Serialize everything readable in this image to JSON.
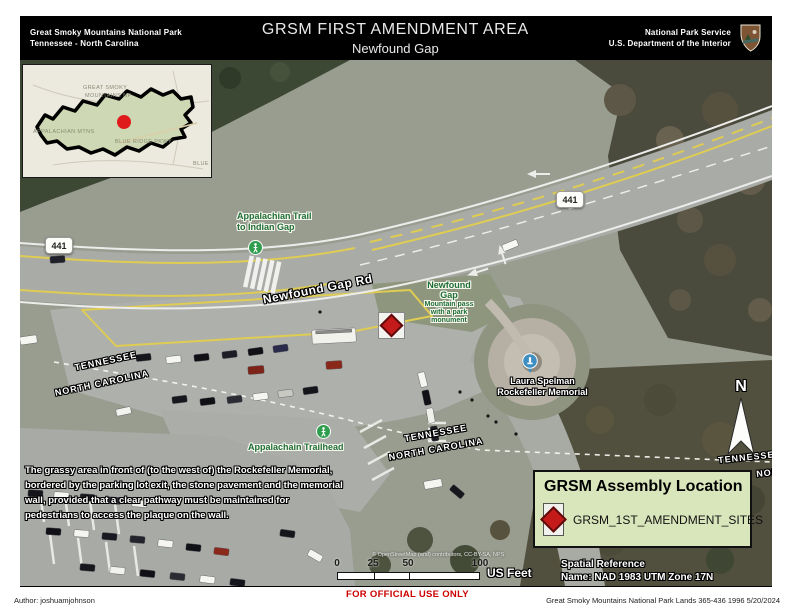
{
  "header": {
    "park_name": "Great Smoky Mountains National Park",
    "park_states": "Tennessee - North Carolina",
    "title": "GRSM FIRST AMENDMENT AREA",
    "subtitle": "Newfound Gap",
    "agency": "National Park Service",
    "department": "U.S. Department of the Interior",
    "logo_icon": "nps-arrowhead-icon"
  },
  "inset": {
    "park_label_line1": "GREAT SMOKY",
    "park_label_line2": "MOUNTAINS NP",
    "region_label": "APPALACHIAN MTNS",
    "parkway_label": "BLUE RIDGE PKWY",
    "edge_label": "BLUE",
    "marker_icon": "red-dot-location-marker"
  },
  "map": {
    "route_shield": "441",
    "trail_label_line1": "Appalachian Trail",
    "trail_label_line2": "to Indian Gap",
    "road_label": "Newfound Gap Rd",
    "gap_label_line1": "Newfound",
    "gap_label_line2": "Gap",
    "gap_sublabel_line1": "Mountain pass",
    "gap_sublabel_line2": "with a park",
    "gap_sublabel_line3": "monument",
    "memorial_label_line1": "Laura Spelman",
    "memorial_label_line2": "Rockefeller Memorial",
    "trailhead_label": "Appalachain Trailhead",
    "state_tennessee": "TENNESSEE",
    "state_north_carolina": "NORTH CAROLINA",
    "north_label": "N",
    "description_lines": [
      "The grassy area in front of (to the west of) the Rockefeller Memorial,",
      "bordered by the parking lot exit, the stone pavement and the memorial",
      "wall, provided that a clear pathway must be maintained for",
      "pedestrians to access the plaque on the wall."
    ],
    "attribution": "© OpenStreetMap (and) contributors, CC-BY-SA, NPS"
  },
  "legend": {
    "title": "GRSM Assembly Location",
    "item_label": "GRSM_1ST_AMENDMENT_SITES",
    "item_icon": "red-diamond-site-marker"
  },
  "scale_bar": {
    "ticks": [
      "0",
      "25",
      "50",
      "100"
    ],
    "unit": "US Feet"
  },
  "spatial_reference": {
    "line1": "Spatial Reference",
    "line2": "Name: NAD 1983 UTM Zone 17N"
  },
  "footer": {
    "author": "Author: joshuamjohnson",
    "official_use": "FOR OFFICIAL USE ONLY",
    "credits": "Great Smoky Mountains National Park Lands 365-436 1996 5/20/2024"
  },
  "colors": {
    "header_bg": "#000000",
    "legend_bg": "#d9e5ba",
    "site_marker_red": "#c41a1a",
    "official_use_red": "#cc0000",
    "poi_green": "#2c7a3c",
    "road_paint_yellow": "#dfcc52"
  }
}
